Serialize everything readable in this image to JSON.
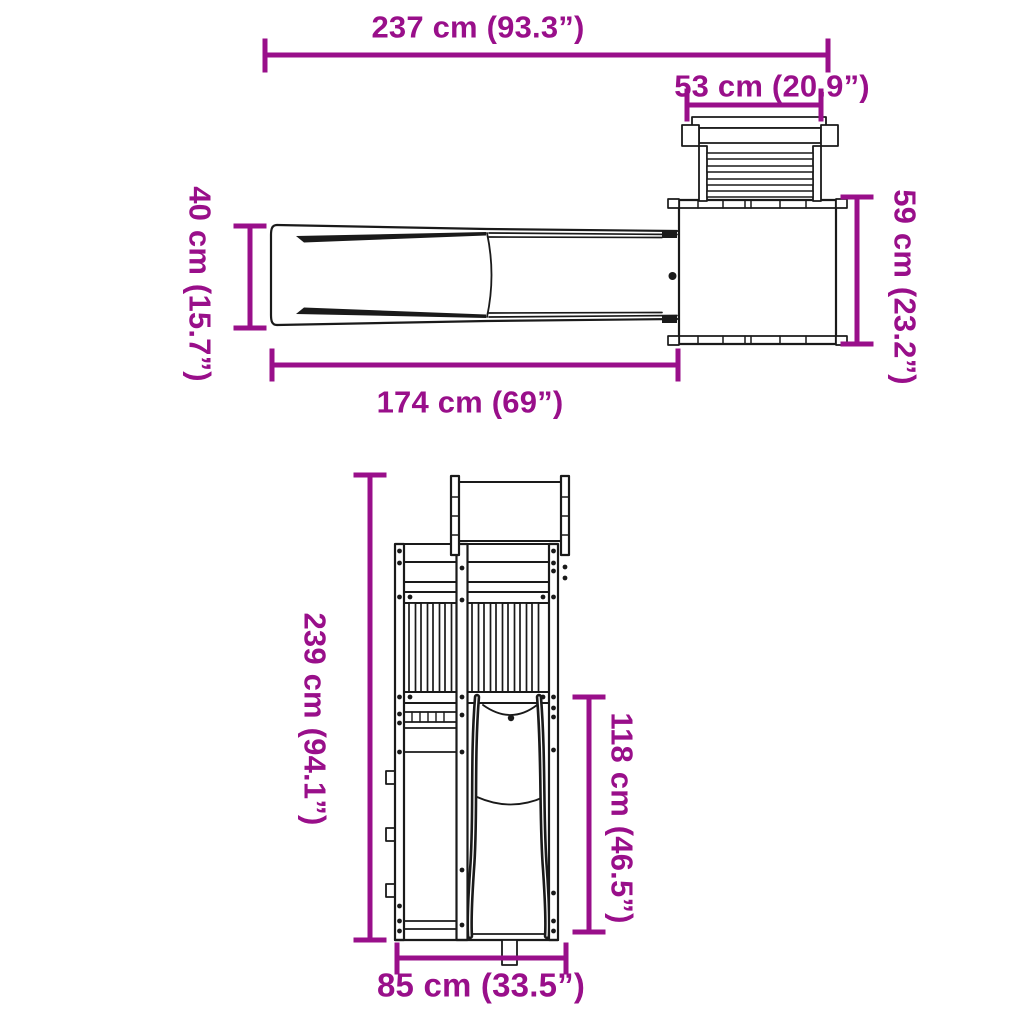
{
  "diagram": {
    "accent_color": "#990f8a",
    "line_color": "#1a1a1a",
    "background_color": "#ffffff"
  },
  "dimensions": {
    "d237": {
      "label": "237 cm (93.3”)",
      "cm": 237,
      "in": 93.3
    },
    "d53": {
      "label": "53 cm (20.9”)",
      "cm": 53,
      "in": 20.9
    },
    "d40": {
      "label": "40 cm (15.7”)",
      "cm": 40,
      "in": 15.7
    },
    "d59": {
      "label": "59 cm (23.2”)",
      "cm": 59,
      "in": 23.2
    },
    "d174": {
      "label": "174 cm (69”)",
      "cm": 174,
      "in": 69
    },
    "d239": {
      "label": "239 cm (94.1”)",
      "cm": 239,
      "in": 94.1
    },
    "d118": {
      "label": "118 cm (46.5”)",
      "cm": 118,
      "in": 46.5
    },
    "d85": {
      "label": "85 cm (33.5”)",
      "cm": 85,
      "in": 33.5
    }
  }
}
